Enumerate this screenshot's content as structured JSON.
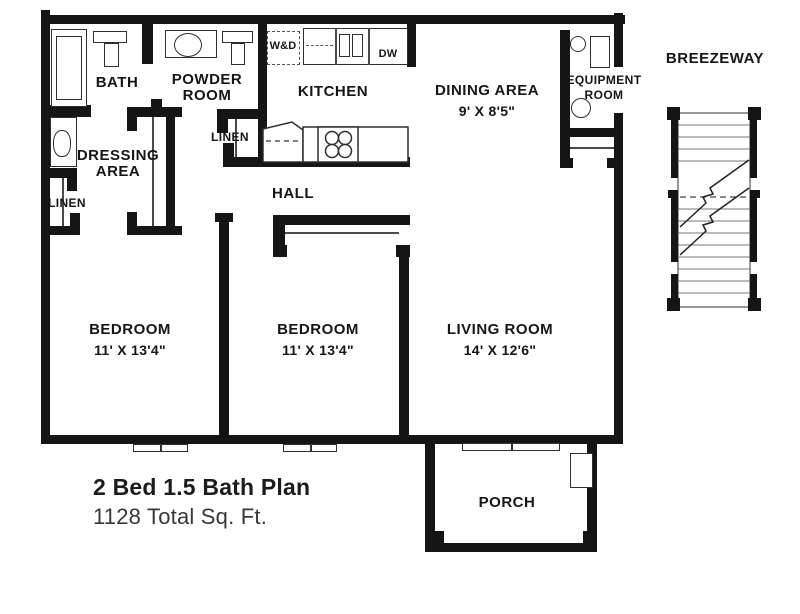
{
  "plan": {
    "rooms": {
      "bath": {
        "label": "BATH"
      },
      "powder": {
        "line1": "POWDER",
        "line2": "ROOM"
      },
      "kitchen": {
        "label": "KITCHEN"
      },
      "dining": {
        "label": "DINING AREA",
        "dims": "9' X 8'5\""
      },
      "equipment": {
        "line1": "EQUIPMENT",
        "line2": "ROOM"
      },
      "breezeway": {
        "label": "BREEZEWAY"
      },
      "dressing": {
        "line1": "DRESSING",
        "line2": "AREA"
      },
      "linen_left": {
        "label": "LINEN"
      },
      "linen_mid": {
        "label": "LINEN"
      },
      "hall": {
        "label": "HALL"
      },
      "bedroom1": {
        "label": "BEDROOM",
        "dims": "11' X 13'4\""
      },
      "bedroom2": {
        "label": "BEDROOM",
        "dims": "11' X 13'4\""
      },
      "living": {
        "label": "LIVING ROOM",
        "dims": "14' X 12'6\""
      },
      "porch": {
        "label": "PORCH"
      }
    },
    "appliances": {
      "washer_dryer": "W&D",
      "dishwasher": "DW"
    },
    "title": "2 Bed 1.5 Bath Plan",
    "subtitle": "1128 Total Sq. Ft."
  }
}
